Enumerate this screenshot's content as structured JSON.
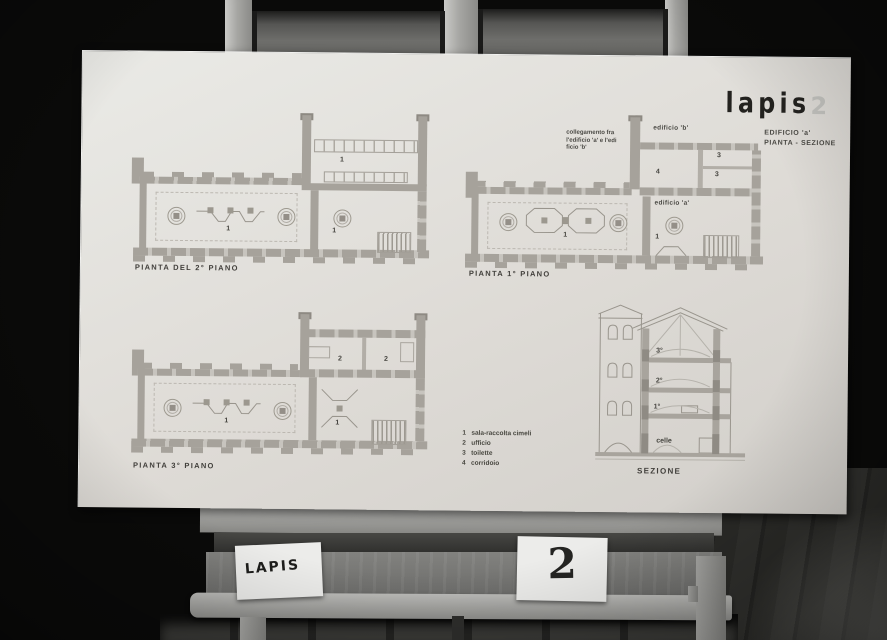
{
  "colors": {
    "background": "#0a0a09",
    "board": "#dedbd6",
    "wall_gray": "#a6a29b",
    "ink": "#45443f",
    "wood_gray": "#8f8f8c"
  },
  "board": {
    "logo_text": "lapis",
    "logo_number": "2",
    "subtitle_line1": "EDIFICIO 'a'",
    "subtitle_line2": "PIANTA - SEZIONE",
    "room_numbers": {
      "r1": "1",
      "r2": "2",
      "r3": "3",
      "r4": "4"
    },
    "plans": {
      "plan_second": {
        "title": "PIANTA DEL 2° PIANO"
      },
      "plan_first": {
        "title": "PIANTA 1° PIANO"
      },
      "plan_third": {
        "title": "PIANTA 3° PIANO"
      }
    },
    "annotations": {
      "collegamento_line1": "collegamento fra",
      "collegamento_line2": "l'edificio 'a' e l'edi",
      "collegamento_line3": "ficio 'b'",
      "edificio_b": "edificio 'b'",
      "edificio_a": "edificio 'a'"
    },
    "legend": {
      "items": [
        {
          "num": "1",
          "label": "sala-raccolta cimeli"
        },
        {
          "num": "2",
          "label": "ufficio"
        },
        {
          "num": "3",
          "label": "toilette"
        },
        {
          "num": "4",
          "label": "corridoio"
        }
      ]
    },
    "section": {
      "title": "SEZIONE",
      "floor_3": "3°",
      "floor_2": "2°",
      "floor_1": "1°",
      "basement": "celle"
    }
  },
  "cards": {
    "left_label": "LAPIS",
    "right_label": "2"
  }
}
